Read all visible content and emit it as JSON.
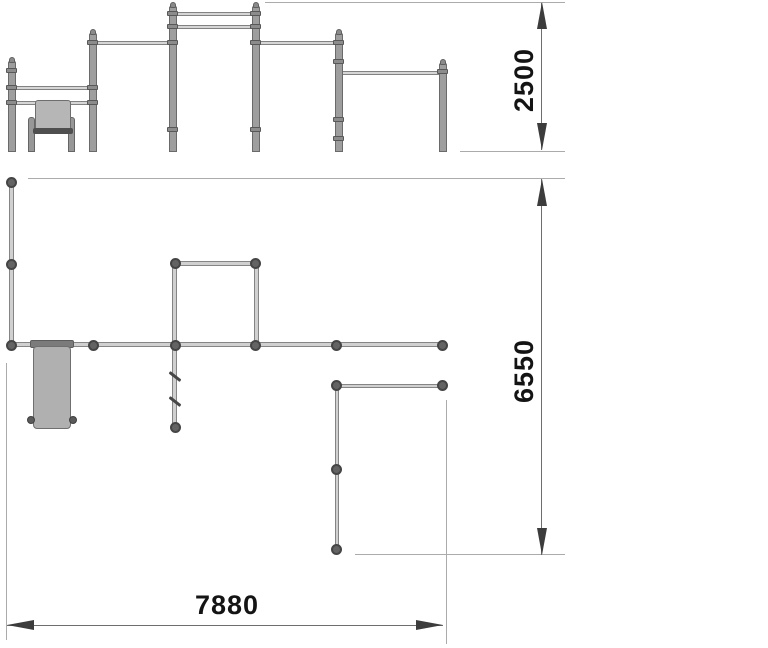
{
  "drawing": {
    "type": "street-workout-station technical drawing",
    "views": 2,
    "dimensions": {
      "height_mm": "2500",
      "site_depth_mm": "6550",
      "site_width_mm": "7880"
    },
    "colors": {
      "metal": "#9e9e9e",
      "metal_edge": "#6a6a6a",
      "node": "#636363",
      "dimension_line": "#6e6e6e",
      "extension_line": "#ababab",
      "arrow": "#3c3c3c",
      "text": "#141414",
      "background": "#ffffff"
    }
  }
}
